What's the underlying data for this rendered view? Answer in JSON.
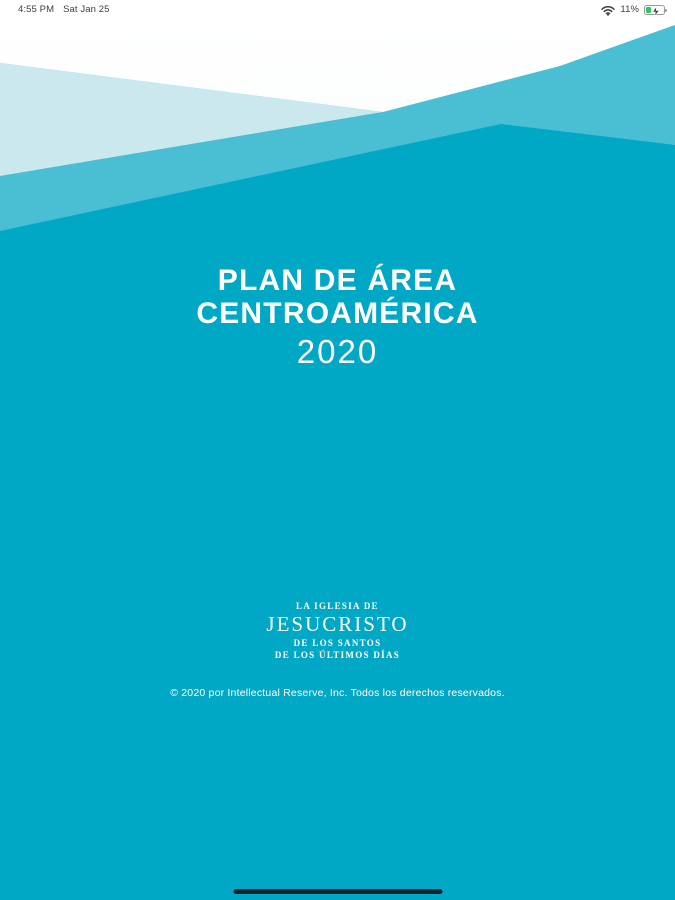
{
  "status_bar": {
    "time": "4:55 PM",
    "date": "Sat Jan 25",
    "battery_percent": "11%",
    "wifi_icon": "wifi",
    "battery_icon": "battery-charging"
  },
  "cover": {
    "title_line1": "PLAN DE ÁREA",
    "title_line2": "CENTROAMÉRICA",
    "year": "2020",
    "logo": {
      "line1": "LA IGLESIA DE",
      "name": "JESUCRISTO",
      "line3": "DE LOS SANTOS",
      "line4": "DE LOS ÚLTIMOS DÍAS"
    },
    "copyright": "© 2020 por Intellectual Reserve, Inc. Todos los derechos reservados."
  },
  "theme": {
    "teal-dark": "#01a8c5",
    "teal-medium": "#4abfd4",
    "teal-light": "#cbe8ef",
    "battery-green": "#32c759",
    "indicator": "#0d2731"
  }
}
